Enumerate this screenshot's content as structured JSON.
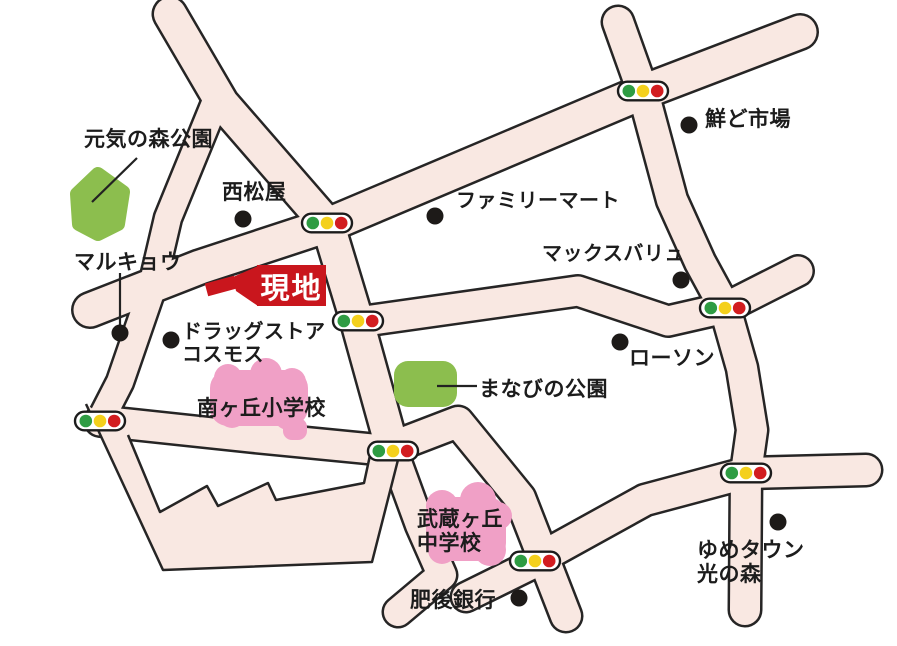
{
  "map": {
    "colors": {
      "background": "#ffffff",
      "road_fill": "#f9e8e2",
      "road_casing": "#262525",
      "park_green": "#8cbe4e",
      "school_pink": "#f0a0c6",
      "site_red": "#c9161d",
      "signal_green": "#2e9c43",
      "signal_yellow": "#f4d01c",
      "signal_red": "#d21d20",
      "signal_pill_fill": "#ffffff",
      "signal_pill_stroke": "#1c1c1c",
      "landmark_dot": "#1d1a18",
      "text": "#1c1c1c",
      "pointer_line": "#222222"
    },
    "roads": [
      {
        "id": "north-cap-road",
        "width": 32,
        "points": [
          [
            170,
            14
          ],
          [
            222,
            103
          ],
          [
            328,
            225
          ],
          [
            357,
            321
          ],
          [
            393,
            451
          ]
        ]
      },
      {
        "id": "marukyo-road",
        "width": 26,
        "points": [
          [
            215,
            103
          ],
          [
            168,
            218
          ],
          [
            150,
            295
          ],
          [
            120,
            382
          ],
          [
            100,
            421
          ]
        ]
      },
      {
        "id": "main-diagonal-road",
        "width": 33,
        "points": [
          [
            90,
            310
          ],
          [
            200,
            267
          ],
          [
            328,
            225
          ],
          [
            643,
            92
          ],
          [
            800,
            32
          ]
        ]
      },
      {
        "id": "north-south-road",
        "width": 30,
        "points": [
          [
            618,
            22
          ],
          [
            643,
            92
          ],
          [
            672,
            200
          ],
          [
            700,
            262
          ],
          [
            725,
            308
          ],
          [
            742,
            368
          ],
          [
            752,
            430
          ],
          [
            746,
            473
          ],
          [
            745,
            610
          ]
        ]
      },
      {
        "id": "middle-zigzag-road",
        "width": 29,
        "points": [
          [
            358,
            322
          ],
          [
            578,
            291
          ],
          [
            668,
            321
          ],
          [
            725,
            308
          ],
          [
            798,
            271
          ]
        ]
      },
      {
        "id": "west-horizontal-road",
        "width": 29,
        "points": [
          [
            100,
            421
          ],
          [
            250,
            437
          ],
          [
            393,
            451
          ]
        ]
      },
      {
        "id": "southeast-diagonal-road",
        "width": 30,
        "points": [
          [
            540,
            558
          ],
          [
            645,
            500
          ],
          [
            746,
            473
          ],
          [
            866,
            470
          ]
        ]
      },
      {
        "id": "school-road",
        "width": 30,
        "points": [
          [
            398,
            445
          ],
          [
            458,
            422
          ],
          [
            520,
            498
          ],
          [
            545,
            562
          ],
          [
            566,
            616
          ]
        ]
      },
      {
        "id": "bank-link-road",
        "width": 28,
        "points": [
          [
            535,
            563
          ],
          [
            466,
            597
          ]
        ]
      },
      {
        "id": "south-stub-road",
        "width": 28,
        "points": [
          [
            393,
            451
          ],
          [
            420,
            525
          ],
          [
            442,
            575
          ],
          [
            398,
            612
          ]
        ]
      }
    ],
    "loop_band": {
      "fill_points": [
        [
          86,
          404
        ],
        [
          163,
          570
        ],
        [
          372,
          562
        ],
        [
          400,
          452
        ],
        [
          372,
          446
        ],
        [
          364,
          483
        ],
        [
          276,
          500
        ],
        [
          268,
          483
        ],
        [
          218,
          506
        ],
        [
          207,
          486
        ],
        [
          160,
          512
        ],
        [
          128,
          435
        ]
      ],
      "outer_stroke": [
        [
          86,
          404
        ],
        [
          163,
          570
        ],
        [
          372,
          562
        ],
        [
          400,
          452
        ]
      ],
      "inner_stroke": [
        [
          372,
          446
        ],
        [
          364,
          483
        ],
        [
          276,
          500
        ],
        [
          268,
          483
        ],
        [
          218,
          506
        ],
        [
          207,
          486
        ],
        [
          160,
          512
        ],
        [
          128,
          435
        ]
      ]
    },
    "parks": [
      {
        "id": "genki-no-mori-park",
        "shape": "polygon",
        "points": [
          [
            98,
            174
          ],
          [
            123,
            192
          ],
          [
            118,
            224
          ],
          [
            98,
            234
          ],
          [
            79,
            224
          ],
          [
            77,
            194
          ]
        ]
      },
      {
        "id": "manabi-park",
        "shape": "rect",
        "x": 394,
        "y": 361,
        "w": 63,
        "h": 46,
        "rx": 14
      }
    ],
    "schools": [
      {
        "id": "minamigaoka-elementary-grounds",
        "rects": [
          [
            210,
            370,
            98,
            56,
            18
          ],
          [
            283,
            418,
            24,
            22,
            9
          ]
        ],
        "circles": [
          [
            228,
            378,
            14
          ],
          [
            266,
            374,
            16
          ],
          [
            292,
            382,
            14
          ],
          [
            232,
            414,
            14
          ],
          [
            288,
            416,
            14
          ]
        ]
      },
      {
        "id": "musashigaoka-junior-high-grounds",
        "rects": [
          [
            426,
            497,
            80,
            64,
            18
          ]
        ],
        "circles": [
          [
            442,
            506,
            16
          ],
          [
            478,
            500,
            18
          ],
          [
            498,
            516,
            14
          ],
          [
            442,
            550,
            14
          ],
          [
            490,
            550,
            16
          ]
        ]
      }
    ],
    "pointer_lines": [
      {
        "id": "genki-park-pointer",
        "x1": 137,
        "y1": 158,
        "x2": 92,
        "y2": 202
      },
      {
        "id": "marukyo-pointer",
        "x1": 120,
        "y1": 273,
        "x2": 120,
        "y2": 330
      },
      {
        "id": "manabi-park-pointer",
        "x1": 437,
        "y1": 386,
        "x2": 477,
        "y2": 386
      }
    ],
    "landmark_dots": [
      {
        "id": "nishimatsuya-dot",
        "x": 243,
        "y": 219
      },
      {
        "id": "familymart-dot",
        "x": 435,
        "y": 216
      },
      {
        "id": "sendo-ichiba-dot",
        "x": 689,
        "y": 125
      },
      {
        "id": "maxvalu-dot",
        "x": 681,
        "y": 280
      },
      {
        "id": "lawson-dot",
        "x": 620,
        "y": 342
      },
      {
        "id": "marukyo-dot",
        "x": 120,
        "y": 333
      },
      {
        "id": "cosmos-dot",
        "x": 171,
        "y": 340
      },
      {
        "id": "higo-bank-dot",
        "x": 519,
        "y": 598
      },
      {
        "id": "yumetown-dot",
        "x": 778,
        "y": 522
      }
    ],
    "traffic_lights": [
      {
        "id": "signal-top",
        "x": 643,
        "y": 91
      },
      {
        "id": "signal-nishimatsuya",
        "x": 327,
        "y": 223
      },
      {
        "id": "signal-site",
        "x": 358,
        "y": 321
      },
      {
        "id": "signal-lawson",
        "x": 725,
        "y": 308
      },
      {
        "id": "signal-west",
        "x": 100,
        "y": 421
      },
      {
        "id": "signal-school",
        "x": 393,
        "y": 451
      },
      {
        "id": "signal-east",
        "x": 746,
        "y": 473
      },
      {
        "id": "signal-higobank",
        "x": 535,
        "y": 561
      }
    ],
    "labels": [
      {
        "id": "genki-no-mori-park",
        "text": "元気の森公園",
        "x": 84,
        "y": 128,
        "size": 21
      },
      {
        "id": "nishimatsuya",
        "text": "西松屋",
        "x": 222,
        "y": 181,
        "size": 21
      },
      {
        "id": "familymart",
        "text": "ファミリーマート",
        "x": 456,
        "y": 190,
        "size": 20
      },
      {
        "id": "sendo-ichiba",
        "text": "鮮ど市場",
        "x": 705,
        "y": 108,
        "size": 21
      },
      {
        "id": "maxvalu",
        "text": "マックスバリュ",
        "x": 542,
        "y": 243,
        "size": 20
      },
      {
        "id": "marukyo",
        "text": "マルキョウ",
        "x": 74,
        "y": 251,
        "size": 21
      },
      {
        "id": "drugstore-line1",
        "text": "ドラッグストア",
        "x": 182,
        "y": 321,
        "size": 20
      },
      {
        "id": "drugstore-line2",
        "text": "コスモス",
        "x": 182,
        "y": 344,
        "size": 20
      },
      {
        "id": "minamigaoka-elementary",
        "text": "南ヶ丘小学校",
        "x": 197,
        "y": 397,
        "size": 21
      },
      {
        "id": "manabi-park",
        "text": "まなびの公園",
        "x": 479,
        "y": 378,
        "size": 21
      },
      {
        "id": "lawson",
        "text": "ローソン",
        "x": 629,
        "y": 347,
        "size": 21
      },
      {
        "id": "musashigaoka-line1",
        "text": "武蔵ヶ丘",
        "x": 417,
        "y": 508,
        "size": 21
      },
      {
        "id": "musashigaoka-line2",
        "text": "中学校",
        "x": 417,
        "y": 532,
        "size": 21
      },
      {
        "id": "higo-bank",
        "text": "肥後銀行",
        "x": 410,
        "y": 589,
        "size": 21
      },
      {
        "id": "yumetown-line1",
        "text": "ゆめタウン",
        "x": 697,
        "y": 539,
        "size": 21
      },
      {
        "id": "yumetown-line2",
        "text": "光の森",
        "x": 697,
        "y": 563,
        "size": 21
      }
    ],
    "site_marker": {
      "label": "現地",
      "box": {
        "x": 257,
        "y": 265,
        "w": 69,
        "h": 41,
        "font_size": 29
      },
      "horn_polygon": [
        [
          233,
          277
        ],
        [
          258,
          266
        ],
        [
          258,
          306
        ],
        [
          236,
          291
        ]
      ],
      "bar_polygon": [
        [
          204.8,
          283.6
        ],
        [
          233.8,
          275.8
        ],
        [
          237.2,
          288.4
        ],
        [
          208.2,
          296.2
        ]
      ]
    }
  }
}
